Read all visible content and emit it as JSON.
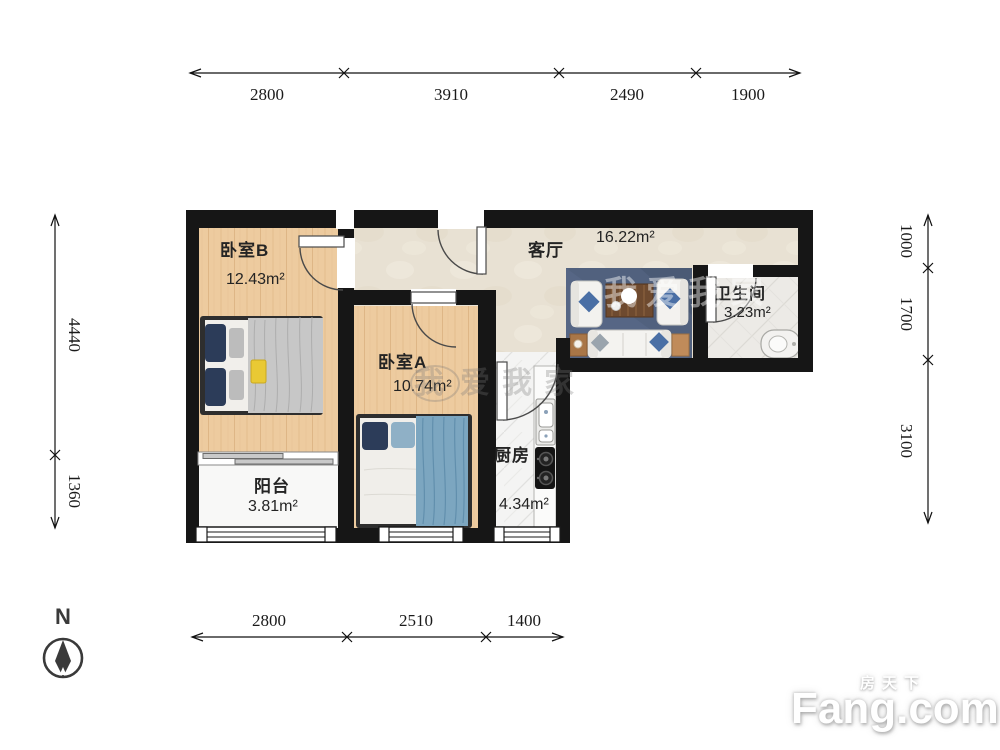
{
  "rooms": {
    "bedroomB": {
      "name": "卧室B",
      "area": "12.43m²"
    },
    "bedroomA": {
      "name": "卧室A",
      "area": "10.74m²"
    },
    "living": {
      "name": "客厅",
      "area": "16.22m²"
    },
    "bath": {
      "name": "卫生间",
      "area": "3.23m²"
    },
    "kitchen": {
      "name": "厨房",
      "area": "4.34m²"
    },
    "balcony": {
      "name": "阳台",
      "area": "3.81m²"
    }
  },
  "dims": {
    "top": [
      "2800",
      "3910",
      "2490",
      "1900"
    ],
    "bottom": [
      "2800",
      "2510",
      "1400"
    ],
    "left": [
      "4440",
      "1360"
    ],
    "right": [
      "1000",
      "1700",
      "3100"
    ]
  },
  "compass": {
    "north": "N"
  },
  "watermark": {
    "brand_cn": "房天下",
    "brand_en": "Fang.com",
    "agency": "爱我家",
    "agency_first": "我"
  },
  "colors": {
    "wall": "#161616",
    "wood": "#edcb9f",
    "living_floor": "#e8e1d3",
    "accent_navy": "#2c3c59",
    "blanket_blue": "#7ca6c0"
  }
}
